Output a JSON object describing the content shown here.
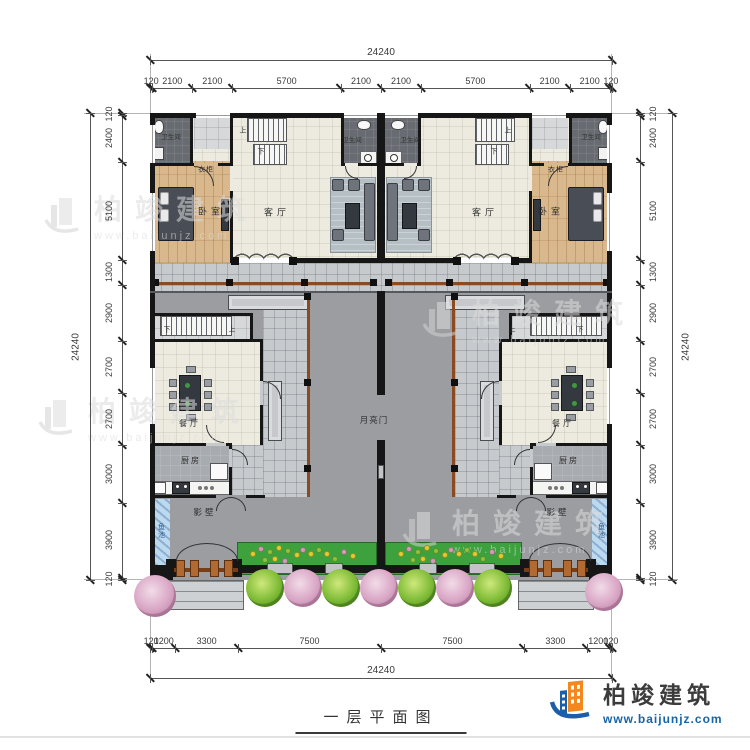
{
  "title": "一层平面图",
  "brand": {
    "name": "柏竣建筑",
    "url": "www.baijunjz.com"
  },
  "dims": {
    "total": "24240",
    "top": [
      "120",
      "2100",
      "2100",
      "5700",
      "2100",
      "2100",
      "5700",
      "2100",
      "2100",
      "120"
    ],
    "bottom": [
      "120",
      "1200",
      "3300",
      "7500",
      "7500",
      "3300",
      "1200",
      "120"
    ],
    "left": [
      "120",
      "2400",
      "5100",
      "1300",
      "2900",
      "2700",
      "2700",
      "3000",
      "3900",
      "120"
    ],
    "right": [
      "120",
      "2400",
      "5100",
      "1300",
      "2900",
      "2700",
      "2700",
      "3000",
      "3900",
      "120"
    ]
  },
  "rooms": {
    "bathroom": "卫生间",
    "wardrobe": "衣柜",
    "bedroom": "卧室",
    "living": "客厅",
    "dining": "餐厅",
    "kitchen": "厨房",
    "screen_wall": "影壁",
    "fish_pond": "鱼池",
    "moon_gate": "月亮门",
    "stair_up": "上",
    "stair_down": "下"
  }
}
